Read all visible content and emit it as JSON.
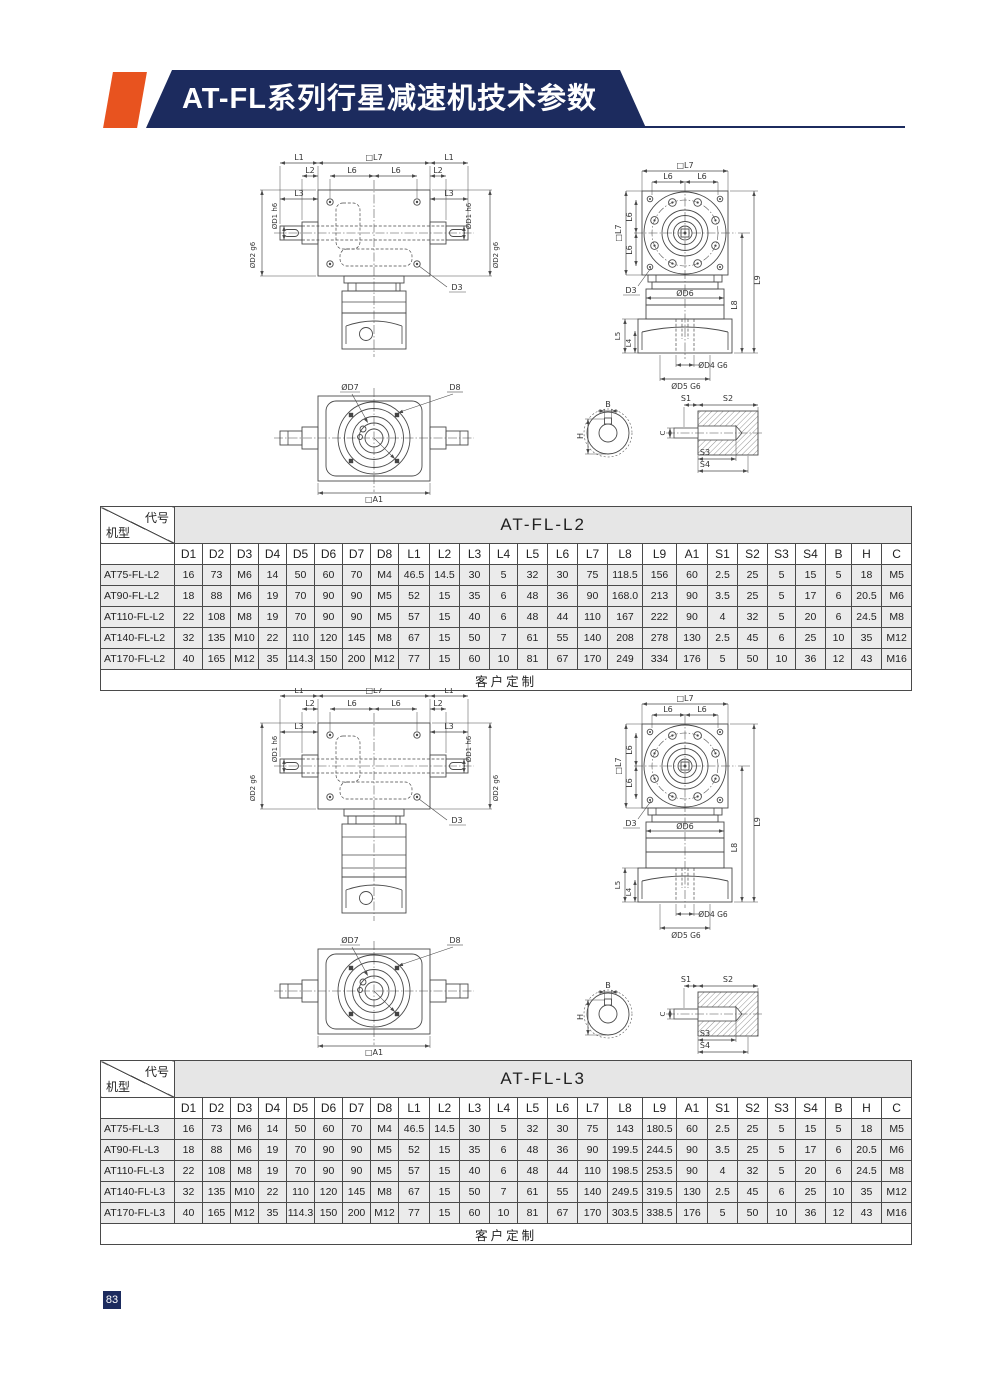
{
  "header": {
    "title": "AT-FL系列行星减速机技术参数"
  },
  "page": {
    "number": "83"
  },
  "colors": {
    "navy": "#1c2b5e",
    "orange": "#e8531f",
    "cell_gray": "#ebebeb"
  },
  "labels": {
    "L1": "L1",
    "L2": "L2",
    "L3": "L3",
    "L4": "L4",
    "L5": "L5",
    "L6": "L6",
    "L7": "□L7",
    "L8": "L8",
    "L9": "L9",
    "D1": "ØD1 h6",
    "D2": "ØD2 g6",
    "D3": "D3",
    "D4": "ØD4 G6",
    "D5": "ØD5 G6",
    "D6": "ØD6",
    "D7": "ØD7",
    "D8": "D8",
    "A1": "□A1",
    "B": "B",
    "H": "H",
    "C": "C",
    "S1": "S1",
    "S2": "S2",
    "S3": "S3",
    "S4": "S4"
  },
  "table_l2": {
    "corner_top": "代号",
    "corner_bottom": "机型",
    "title": "AT-FL-L2",
    "columns": [
      "D1",
      "D2",
      "D3",
      "D4",
      "D5",
      "D6",
      "D7",
      "D8",
      "L1",
      "L2",
      "L3",
      "L4",
      "L5",
      "L6",
      "L7",
      "L8",
      "L9",
      "A1",
      "S1",
      "S2",
      "S3",
      "S4",
      "B",
      "H",
      "C"
    ],
    "rows": [
      {
        "model": "AT75-FL-L2",
        "values": [
          "16",
          "73",
          "M6",
          "14",
          "50",
          "60",
          "70",
          "M4",
          "46.5",
          "14.5",
          "30",
          "5",
          "32",
          "30",
          "75",
          "118.5",
          "156",
          "60",
          "2.5",
          "25",
          "5",
          "15",
          "5",
          "18",
          "M5"
        ]
      },
      {
        "model": "AT90-FL-L2",
        "values": [
          "18",
          "88",
          "M6",
          "19",
          "70",
          "90",
          "90",
          "M5",
          "52",
          "15",
          "35",
          "6",
          "48",
          "36",
          "90",
          "168.0",
          "213",
          "90",
          "3.5",
          "25",
          "5",
          "17",
          "6",
          "20.5",
          "M6"
        ]
      },
      {
        "model": "AT110-FL-L2",
        "values": [
          "22",
          "108",
          "M8",
          "19",
          "70",
          "90",
          "90",
          "M5",
          "57",
          "15",
          "40",
          "6",
          "48",
          "44",
          "110",
          "167",
          "222",
          "90",
          "4",
          "32",
          "5",
          "20",
          "6",
          "24.5",
          "M8"
        ]
      },
      {
        "model": "AT140-FL-L2",
        "values": [
          "32",
          "135",
          "M10",
          "22",
          "110",
          "120",
          "145",
          "M8",
          "67",
          "15",
          "50",
          "7",
          "61",
          "55",
          "140",
          "208",
          "278",
          "130",
          "2.5",
          "45",
          "6",
          "25",
          "10",
          "35",
          "M12"
        ]
      },
      {
        "model": "AT170-FL-L2",
        "values": [
          "40",
          "165",
          "M12",
          "35",
          "114.3",
          "150",
          "200",
          "M12",
          "77",
          "15",
          "60",
          "10",
          "81",
          "67",
          "170",
          "249",
          "334",
          "176",
          "5",
          "50",
          "10",
          "36",
          "12",
          "43",
          "M16"
        ]
      }
    ],
    "footer": "客户定制"
  },
  "table_l3": {
    "corner_top": "代号",
    "corner_bottom": "机型",
    "title": "AT-FL-L3",
    "columns": [
      "D1",
      "D2",
      "D3",
      "D4",
      "D5",
      "D6",
      "D7",
      "D8",
      "L1",
      "L2",
      "L3",
      "L4",
      "L5",
      "L6",
      "L7",
      "L8",
      "L9",
      "A1",
      "S1",
      "S2",
      "S3",
      "S4",
      "B",
      "H",
      "C"
    ],
    "rows": [
      {
        "model": "AT75-FL-L3",
        "values": [
          "16",
          "73",
          "M6",
          "14",
          "50",
          "60",
          "70",
          "M4",
          "46.5",
          "14.5",
          "30",
          "5",
          "32",
          "30",
          "75",
          "143",
          "180.5",
          "60",
          "2.5",
          "25",
          "5",
          "15",
          "5",
          "18",
          "M5"
        ]
      },
      {
        "model": "AT90-FL-L3",
        "values": [
          "18",
          "88",
          "M6",
          "19",
          "70",
          "90",
          "90",
          "M5",
          "52",
          "15",
          "35",
          "6",
          "48",
          "36",
          "90",
          "199.5",
          "244.5",
          "90",
          "3.5",
          "25",
          "5",
          "17",
          "6",
          "20.5",
          "M6"
        ]
      },
      {
        "model": "AT110-FL-L3",
        "values": [
          "22",
          "108",
          "M8",
          "19",
          "70",
          "90",
          "90",
          "M5",
          "57",
          "15",
          "40",
          "6",
          "48",
          "44",
          "110",
          "198.5",
          "253.5",
          "90",
          "4",
          "32",
          "5",
          "20",
          "6",
          "24.5",
          "M8"
        ]
      },
      {
        "model": "AT140-FL-L3",
        "values": [
          "32",
          "135",
          "M10",
          "22",
          "110",
          "120",
          "145",
          "M8",
          "67",
          "15",
          "50",
          "7",
          "61",
          "55",
          "140",
          "249.5",
          "319.5",
          "130",
          "2.5",
          "45",
          "6",
          "25",
          "10",
          "35",
          "M12"
        ]
      },
      {
        "model": "AT170-FL-L3",
        "values": [
          "40",
          "165",
          "M12",
          "35",
          "114.3",
          "150",
          "200",
          "M12",
          "77",
          "15",
          "60",
          "10",
          "81",
          "67",
          "170",
          "303.5",
          "338.5",
          "176",
          "5",
          "50",
          "10",
          "36",
          "12",
          "43",
          "M16"
        ]
      }
    ],
    "footer": "客户定制"
  }
}
